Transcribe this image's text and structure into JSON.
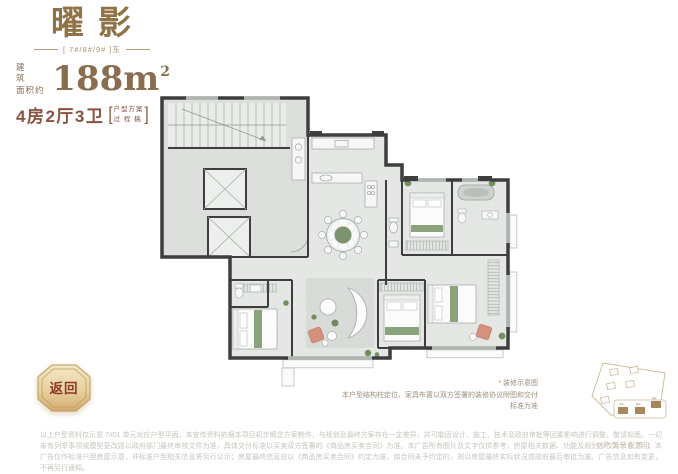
{
  "header": {
    "title": "曜影",
    "subtitle": "[ 7#/8#/9# ]东"
  },
  "area": {
    "label_line1": "建 筑",
    "label_line2": "面积约",
    "value": "188m",
    "sup": "2"
  },
  "rooms": {
    "text": "4房2厅3卫",
    "bracket_open": "[",
    "note_line1": "户型方案",
    "note_line2": "过 程 稿",
    "bracket_close": "]"
  },
  "plan_note": {
    "line1": "* 装修示意图",
    "line2": "本户型结构柱定位、家具布置以双方签署的装修协议附图和交付标准为准"
  },
  "back_button": {
    "label": "返回"
  },
  "siteplan": {
    "caption": "[ 户型分布图 ]",
    "labels": [
      "7#",
      "8#",
      "9#"
    ]
  },
  "disclaimer": {
    "text": "以上户型资料仅示意 7#01 单元对应户型平面，本宣传资料依据本项目初步概念方案制作，与规划及最终方案存在一定差异，并可能因设计、施工、技术及政府审批等因素影响进行调整，敬请知悉。一切未有列举事项或模型更改则以政府部门最终审核文件为准，具体交付标准以买卖双方签署的《商品房买卖合同》为准。本广告所有图片及文字仅供参考，房屋相关数据、功能及规划都仅为示意之用；本广告仅作标准户型房屋示意，非标准户型相关信息将另行公示；房屋最终信息应以《商品房买卖合同》约定为准，如合同未予约定的，则以房屋最终实际状况或政府最后审批为准。广告信息如有变更，不再另行通知。"
  },
  "colors": {
    "accent_gold": "#8f7347",
    "accent_red": "#8a5140",
    "wall": "#3e3e3e",
    "floor": "#e4e7e3",
    "green": "#7c9370",
    "salmon": "#d6917d",
    "disclaimer_text": "#c8c3bc"
  }
}
